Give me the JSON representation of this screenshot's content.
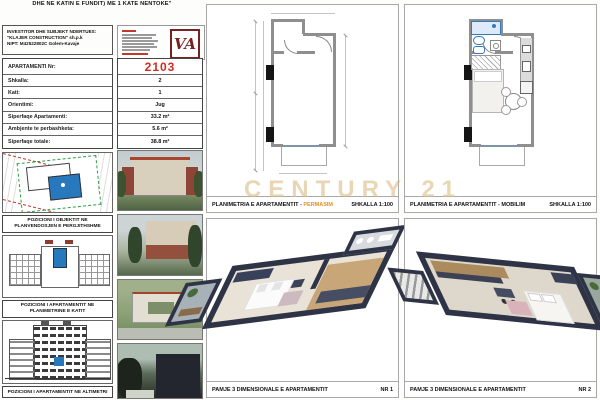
{
  "sheet": {
    "title": "STRUKTURA AKOMODUESE 3 KATE (ME ÇATI NE KATIN E PERDHE DHE NE KATIN E FUNDIT) ME 1 KATE NENTOKE\""
  },
  "investor": {
    "heading": "INVESTITOR DHE SUBJEKT NDERTUES:",
    "name": "\"KLAJER CONSTRUCTION\" sh.p.k",
    "nipt": "NIPT: M42522802C   Golem-Kavaje"
  },
  "stamp": {
    "monogram": "VA"
  },
  "apartment": {
    "rows": [
      {
        "label": "APARTAMENTI Nr:",
        "value": "2103"
      },
      {
        "label": "Shkalla:",
        "value": "2"
      },
      {
        "label": "Kati:",
        "value": "1"
      },
      {
        "label": "Orientimi:",
        "value": "Jug"
      },
      {
        "label": "Siperfaqe Apartamenti:",
        "value": "33.2 m²"
      },
      {
        "label": "Ambjente te perbashketa:",
        "value": "5.6 m²"
      },
      {
        "label": "Siperfaqe totale:",
        "value": "38.8 m²"
      }
    ]
  },
  "captions": [
    "POZICIONI I OBJEKTIT NE PLANVENDOSJEN E PERGJITHSHME",
    "POZICIONI I APARTAMENTIT NE PLANIMETRINE E KATIT",
    "POZICIONI I APARTAMENTIT NE ALTIMETRI"
  ],
  "panels": {
    "permasim": {
      "title_prefix": "PLANIMETRIA E APARTAMENTIT -",
      "highlight": "PERMASIM",
      "scale": "SHKALLA 1:100"
    },
    "mobilim": {
      "title_prefix": "PLANIMETRIA E APARTAMENTIT -",
      "highlight": "MOBILIM",
      "scale": "SHKALLA 1:100"
    },
    "view1": {
      "title": "PAMJE 3 DIMENSIONALE E APARTAMENTIT",
      "number": "NR 1"
    },
    "view2": {
      "title": "PAMJE 3 DIMENSIONALE E APARTAMENTIT",
      "number": "NR 2"
    }
  },
  "watermark": "CENTURY 21",
  "colors": {
    "accent_red": "#d42b1e",
    "highlight_blue": "#2878be",
    "highlight_orange": "#de9226",
    "watermark_gold": "#d9bc85",
    "stamp_maroon": "#7a2020",
    "iso_wall_navy": "#2e3345"
  }
}
